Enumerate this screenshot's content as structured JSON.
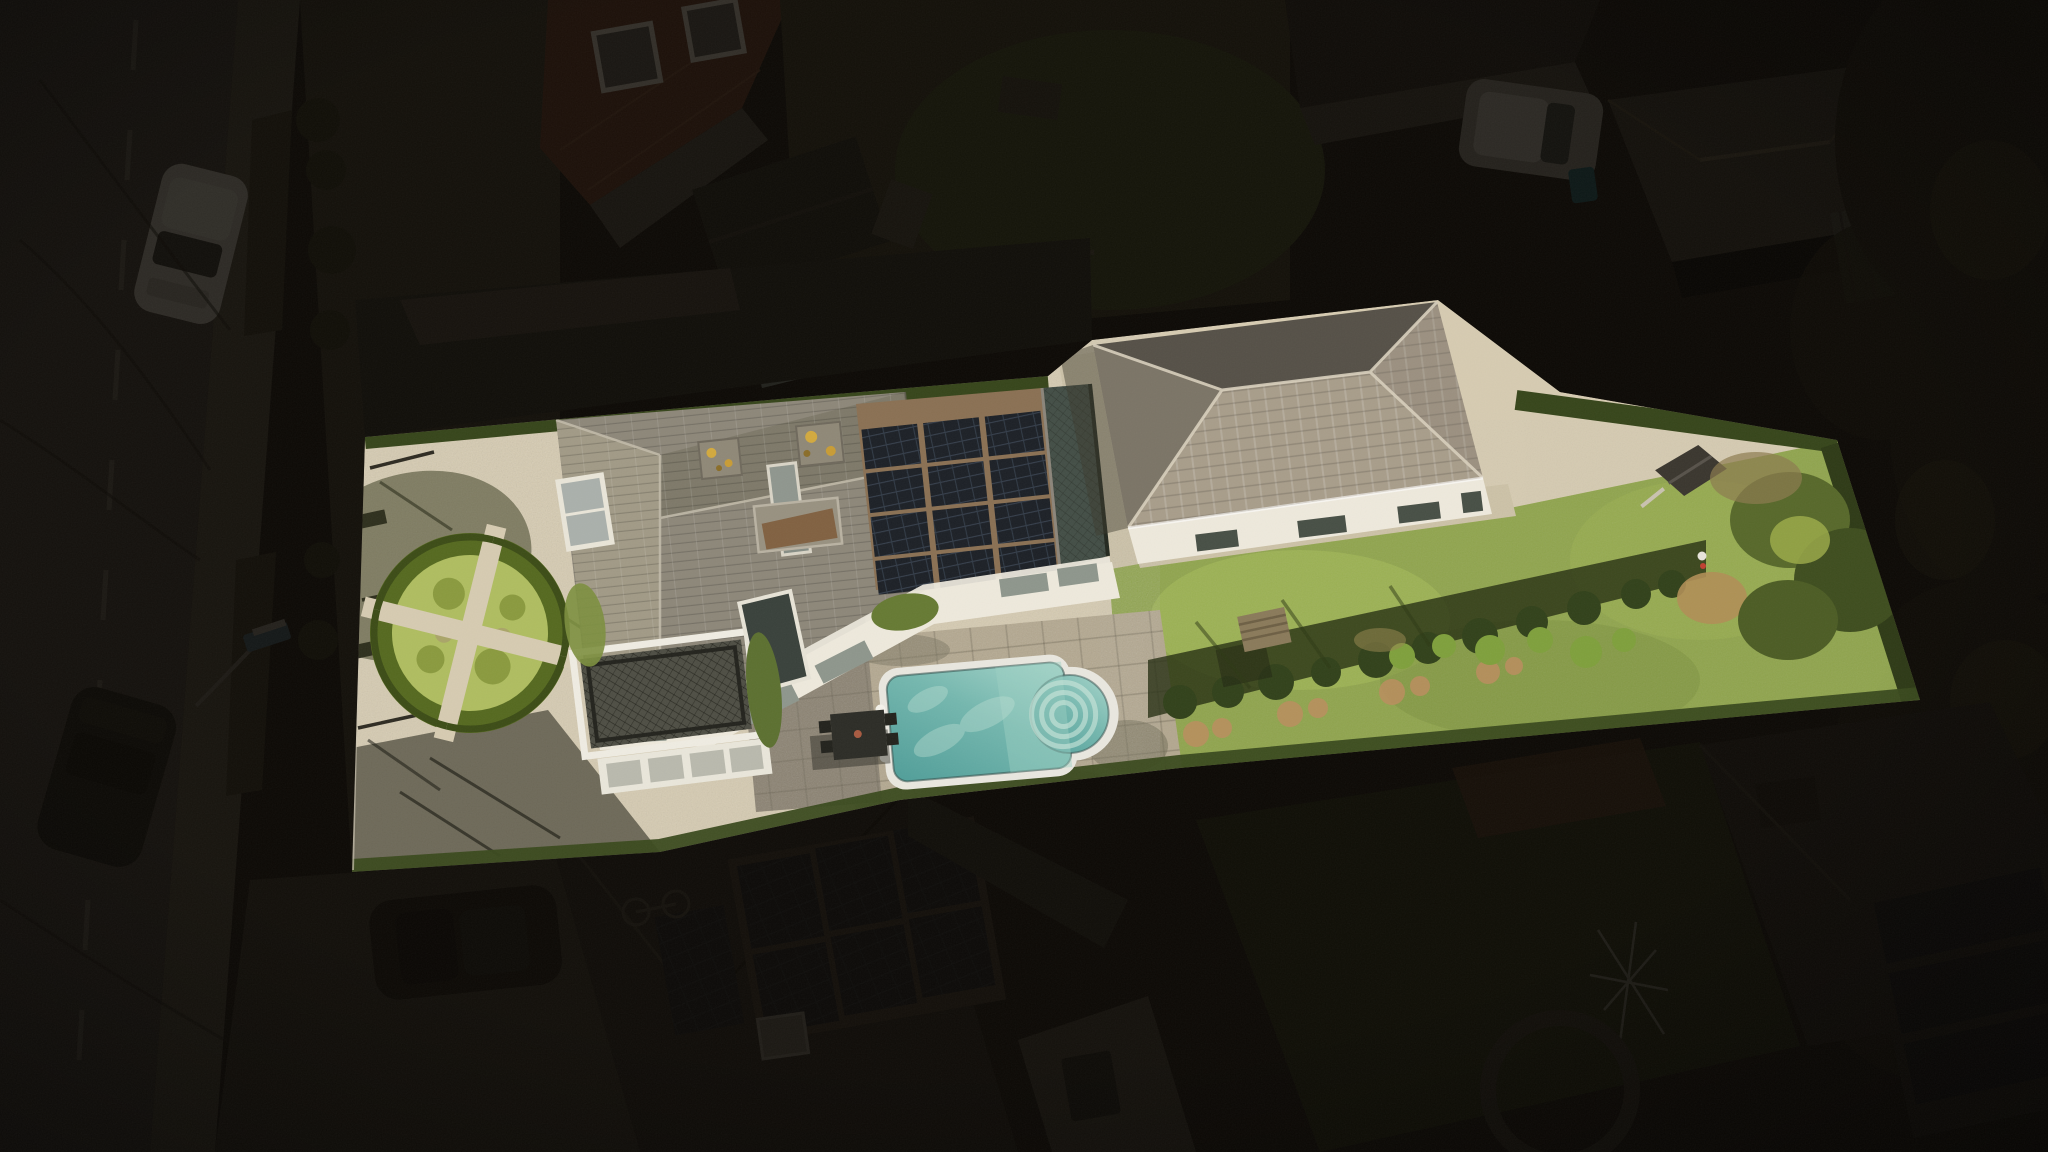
{
  "meta": {
    "type": "aerial-drone-photograph",
    "subject": "residential property listing photo; single parcel brightly highlighted, all surroundings dimmed to near-black",
    "view": "top-down oblique, daytime, long shadows"
  },
  "colors": {
    "backdrop": "#16120d",
    "road": "#3f3932",
    "sidewalk": "#4c4539",
    "road_line": "#938d80",
    "front_yard": "#3a3426",
    "gravel": "#d6cbb1",
    "gravel_shade": "#ab9f84",
    "lawn": "#8fa44b",
    "hedge_green": "#55691f",
    "hedge_dark": "#36451a",
    "parterre_shrub": "#afbd60",
    "roof_grey": "#8d8779",
    "roof_left_face": "#a19a86",
    "roof_top_face": "#7e7969",
    "bungalow_roof_south": "#a89d8a",
    "bungalow_roof_north": "#555047",
    "bungalow_roof_west": "#7b7466",
    "bungalow_roof_east": "#9b9080",
    "ridge_light": "#d8cfbc",
    "wall_white": "#eee9dc",
    "window_glass": "#8e968c",
    "balcony_dark": "#4e4e44",
    "solar_gap": "#8a7053",
    "pool_coping": "#e9e7df",
    "pool_water_deep": "#4f9d98",
    "pool_water_light": "#a9d6cb",
    "patio_stone": "#b3a78e",
    "patio_shade": "#8a8170",
    "table_dark": "#2c2c26",
    "lichen_yellow": "#d2a93e",
    "soil_tan": "#b08e55",
    "neighbor_roof_dark": "#242019",
    "neighbor_roof_red": "#643622",
    "neighbor_wall": "#4c463c",
    "solar_panel_dark": "#14161a",
    "tree_dark": "#201c10",
    "car_white": "#b7b2a8",
    "car_dark": "#17150f",
    "shadow_dark": "#1c1b10",
    "overlay_dim": "rgba(10,7,4,0.80)"
  },
  "scene": {
    "objects": [
      "street",
      "street-lamp",
      "parked-white-car",
      "parked-dark-car",
      "front-yards",
      "highlighted-parcel",
      "gravel-driveway",
      "perimeter-fence",
      "boxwood-parterre-garden",
      "main-house",
      "dormer-window",
      "chimneys",
      "roof-hatch",
      "rooftop-solar-array",
      "roof-terrace",
      "balcony",
      "facade-windows",
      "shaded-patio",
      "swimming-pool",
      "pool-roman-steps",
      "garden-table",
      "bungalow-guesthouse",
      "bungalow-skylights",
      "gravel-apron",
      "lawn",
      "wooden-bench",
      "hedge-row",
      "espalier-shrubs",
      "playhouse",
      "bare-soil-patch",
      "survey-marker",
      "boundary-hedges",
      "neighbor-red-roof-house",
      "neighbor-garden-shed",
      "neighbor-houses-north",
      "neighbor-white-car",
      "neighbor-solar-roof-house",
      "neighbor-gable-wall",
      "neighbor-conservatory",
      "rotary-clothesline",
      "trees",
      "dimming-mask",
      "film-grain"
    ]
  }
}
